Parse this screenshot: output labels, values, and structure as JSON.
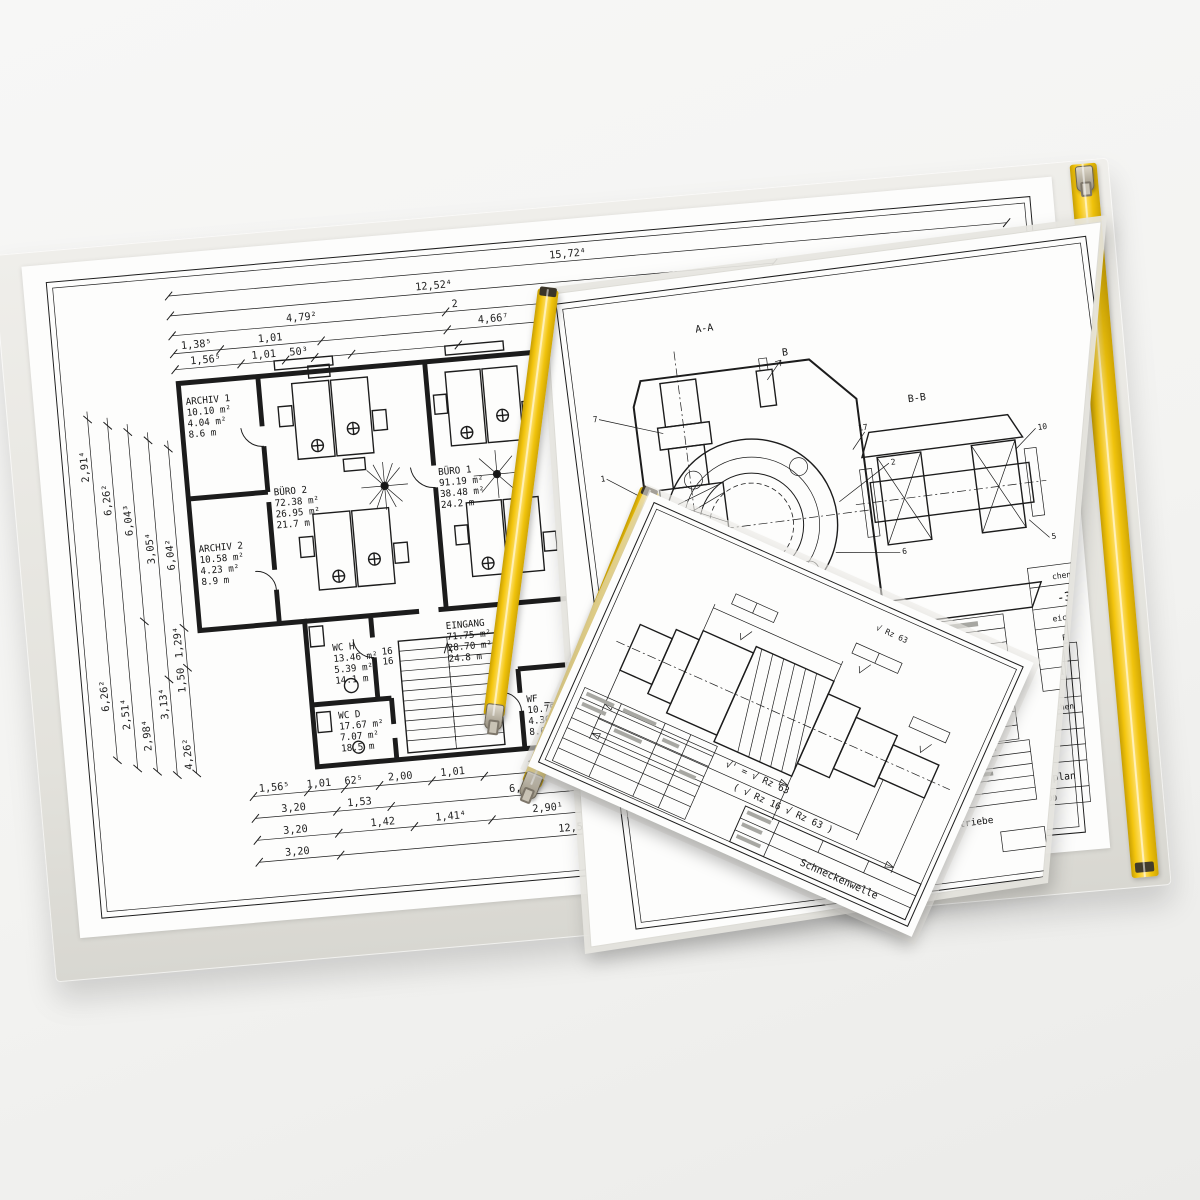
{
  "colors": {
    "zipper_yellow": "#F3C50D",
    "zipper_yellow_light": "#FFE069",
    "sleeve_gray": "#DAD9D3",
    "paper_white": "#FDFDFC",
    "ink": "#1C1C1C",
    "metal_slider": "#B9B2A3",
    "background": "#F4F4F2"
  },
  "floor_plan": {
    "rooms": [
      {
        "name": "ARCHIV 1",
        "l1": "10.10 m²",
        "l2": "4.04 m²",
        "l3": "8.6 m"
      },
      {
        "name": "BÜRO 2",
        "l1": "72.38 m²",
        "l2": "26.95 m²",
        "l3": "21.7 m"
      },
      {
        "name": "ARCHIV 2",
        "l1": "10.58 m²",
        "l2": "4.23 m²",
        "l3": "8.9 m"
      },
      {
        "name": "BÜRO 1",
        "l1": "91.19 m²",
        "l2": "38.48 m²",
        "l3": "24.2 m"
      },
      {
        "name": "EINGANG",
        "l1": "71.75 m²",
        "l2": "28.70 m²",
        "l3": "24.8 m"
      },
      {
        "name": "WC H",
        "l1": "13.46 m²",
        "l2": "5.39 m²",
        "l3": "14.1 m"
      },
      {
        "name": "WC D",
        "l1": "17.67 m²",
        "l2": "7.07 m²",
        "l3": "18.5 m"
      },
      {
        "name": "WF",
        "l1": "10.75 m²",
        "l2": "4.30 m²",
        "l3": "8.6 m"
      }
    ],
    "stairs": [
      "16",
      "16"
    ],
    "dims_top": [
      "15,72⁴",
      "12,52⁴",
      "4,79²",
      "2",
      "6,03³",
      "1,9",
      "1,38⁵",
      "1,01",
      "4,66⁷",
      "1,01",
      "50",
      "2,01",
      "1,00",
      "1,56⁵",
      "1,01",
      "50³"
    ],
    "dims_left": [
      "2,91⁴",
      "6,26²",
      "6,04³",
      "3,05⁴",
      "6,04²",
      "1,29⁴",
      "1,50",
      "3,13⁴",
      "6,26²",
      "2,51⁴",
      "2,98⁴",
      "4,26²"
    ],
    "dims_bottom": [
      "1,56⁵",
      "1,01",
      "62⁵",
      "2,00",
      "1,01",
      "3,49",
      "2,01",
      "2,50⁵",
      "1,01",
      "4,55⁷",
      "3,20",
      "1,53",
      "6,19⁵",
      "4,55²",
      "3,20",
      "1,42",
      "1,41⁴",
      "2,90¹",
      "1,57⁵",
      "3,20",
      "12,52⁴"
    ],
    "title_block": {
      "f1_label": "Unterlage",
      "f1_value": "3",
      "f2_label": "Blatt Nr.",
      "f2_value": "1",
      "f3_label": "Reg. Nr.",
      "col1": "Datum",
      "col2": "Zeichen",
      "s1": "itel",
      "s2": "bnet",
      "s3": "ft",
      "title": "bersichtslageplan",
      "scale": "Maßstab  1:1.000"
    }
  },
  "gear_sheet": {
    "section_a": "A-A",
    "section_b": "B-B",
    "detail_marker": "B",
    "callouts": [
      "1",
      "2",
      "5",
      "6",
      "7",
      "10",
      "15",
      "17"
    ],
    "side_block": [
      "chen",
      "-3",
      "eichen",
      "Bgt",
      "Pöh",
      "Rev"
    ],
    "bottom_title": "eckengetriebe"
  },
  "shaft_sheet": {
    "title": "Schneckenwelle",
    "corner_mark": "√ Rz 63",
    "note1": "√' = √ Rz 63",
    "note2": "( √ Rz 16   √ Rz 63 )"
  }
}
